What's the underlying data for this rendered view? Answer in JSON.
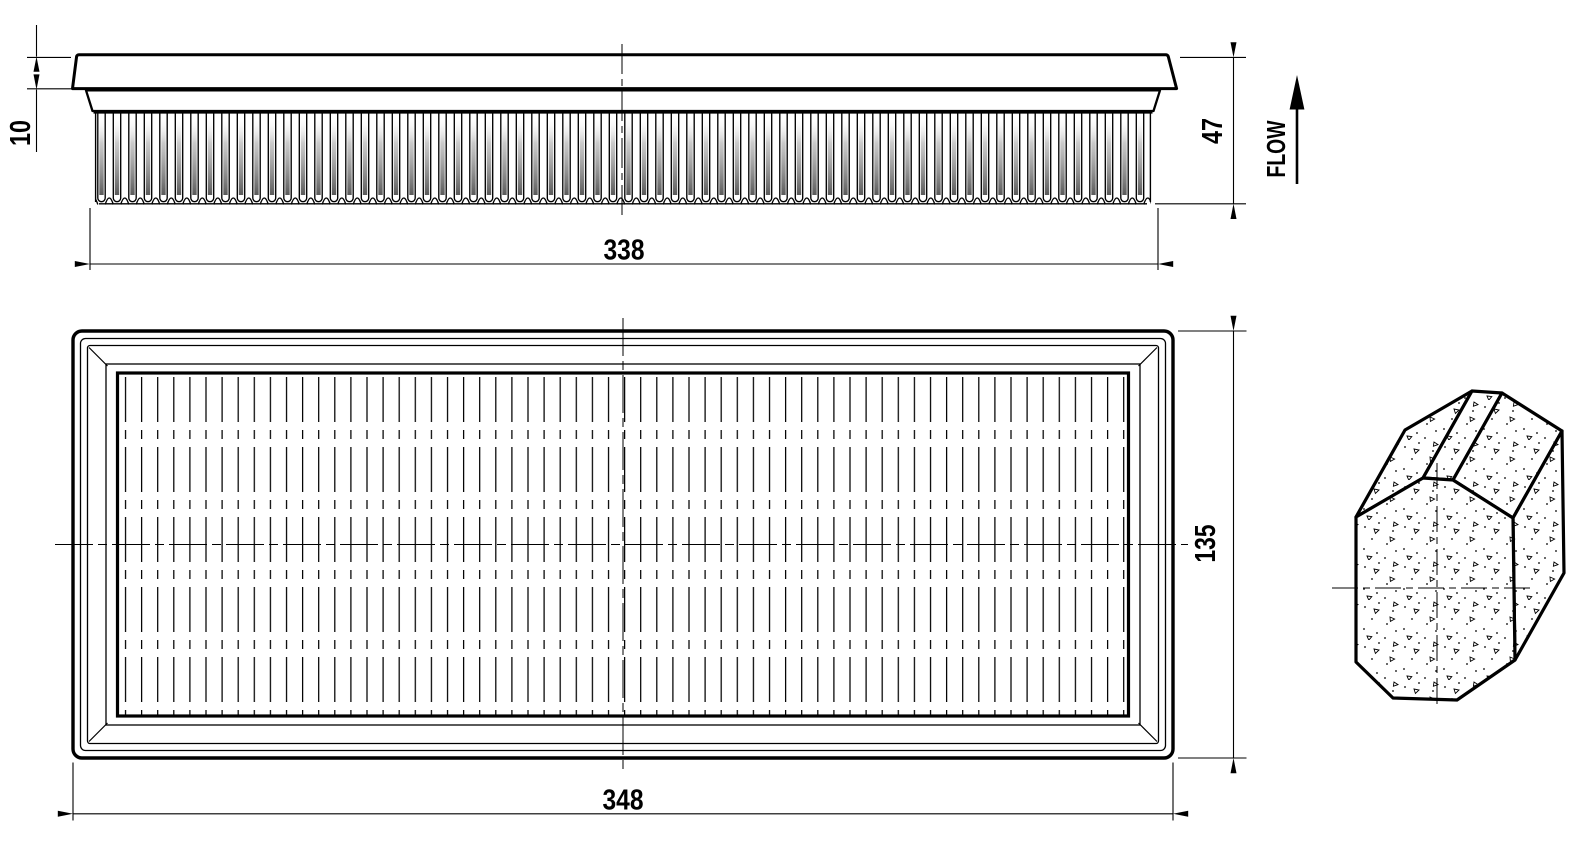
{
  "drawing": {
    "subject": "Panel air filter engineering drawing",
    "colors": {
      "line": "#000000",
      "background": "#ffffff",
      "pleat_shade": "#5a5a5a"
    },
    "dimensions": {
      "lid_height": "10",
      "pleat_pack_length": "338",
      "total_height": "47",
      "overall_length": "348",
      "overall_width": "135"
    },
    "labels": {
      "flow": "FLOW"
    }
  }
}
